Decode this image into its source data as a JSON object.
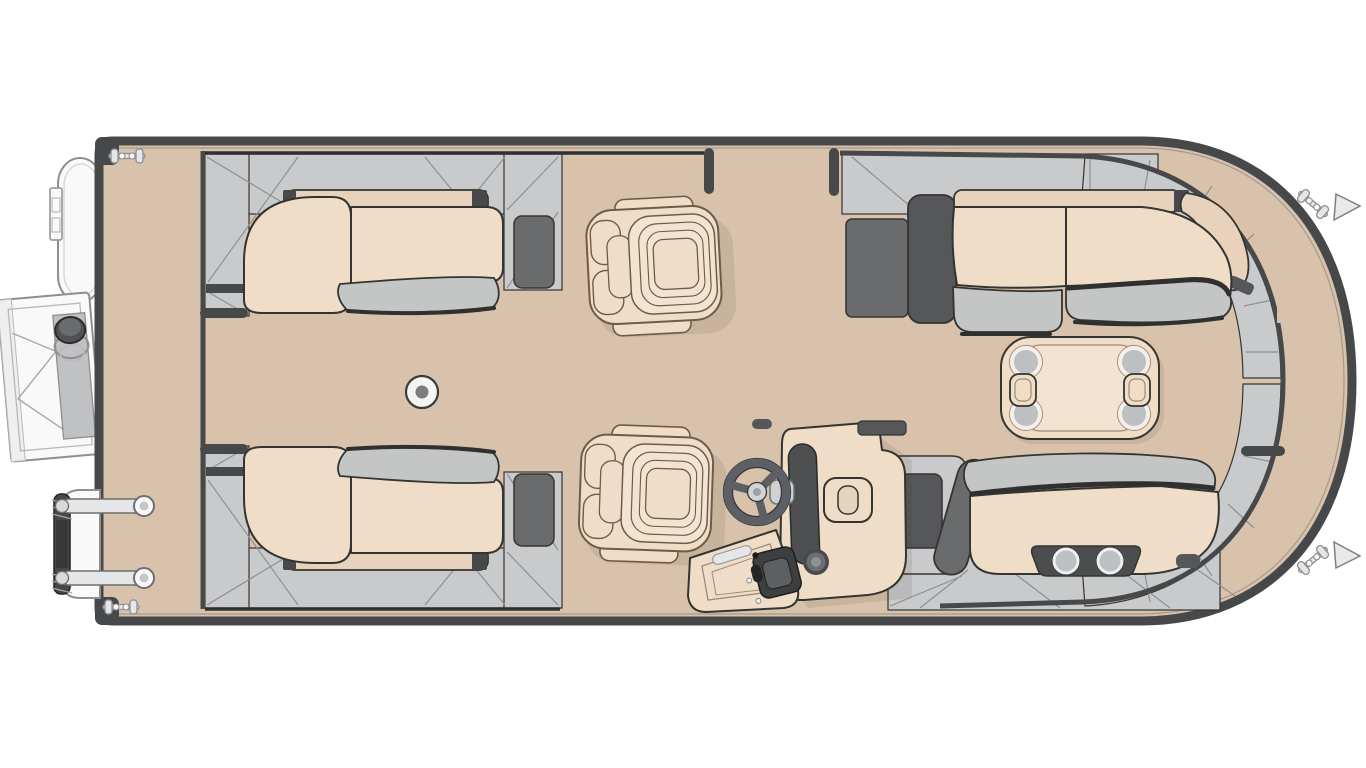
{
  "figure": {
    "title": "Pontoon boat floor plan, top view",
    "width_px": 1366,
    "height_px": 768,
    "background": "#ffffff"
  },
  "palette": {
    "deck": "#d8c2ab",
    "hull": "#47484a",
    "hullDark": "#303032",
    "panel": "#c9cacb",
    "panelLine": "#8f9092",
    "panelDark": "#6a6b6d",
    "accentDark": "#56575a",
    "cushion": "#efddc8",
    "cushionBand": "#e8d2bb",
    "cushionLight": "#f3e4d1",
    "bolster": "#c4c6c5",
    "outline": "#343431",
    "chairLine": "#6e5c49",
    "wheel": "#5c5f63",
    "chrome": "#e4e6e7",
    "metal": "#8f8f91",
    "whitePart": "#f9f9fa",
    "cupGray": "#bcc0c2",
    "cupPanel": "#4c4d4f",
    "tableLine": "#a08c76"
  },
  "components": {
    "hull": "pontoon deck with dark rub-rail, rounded bow at right, squared stern at left",
    "outboard_motor": "outboard motor pod on stern exterior (top-left)",
    "boarding_gate_ladder": "open side gate with boarding ladder (mid-left exterior)",
    "stowed_ladder": "folded two-rail boarding ladder (bottom-left exterior)",
    "cleat_count": 4,
    "gates": [
      "side gate opening in top fence",
      "bow gate opening in right fence"
    ],
    "lounges": [
      "L-shaped lounge, top-left",
      "L-shaped lounge, bottom-left",
      "bow lounge with wrap end, top-right",
      "bow lounge with twin cup holders, bottom-right"
    ],
    "captain_chairs": [
      "companion captain chair (top center)",
      "helm captain chair (bottom center)"
    ],
    "helm_console": "helm console with steering wheel, dash pad, speaker, throttle box",
    "table": "cocktail table with 4 cup holders and 2 grab handles",
    "deck_fitting": "round table-base floor mount",
    "aft_cup_holders": 2
  }
}
